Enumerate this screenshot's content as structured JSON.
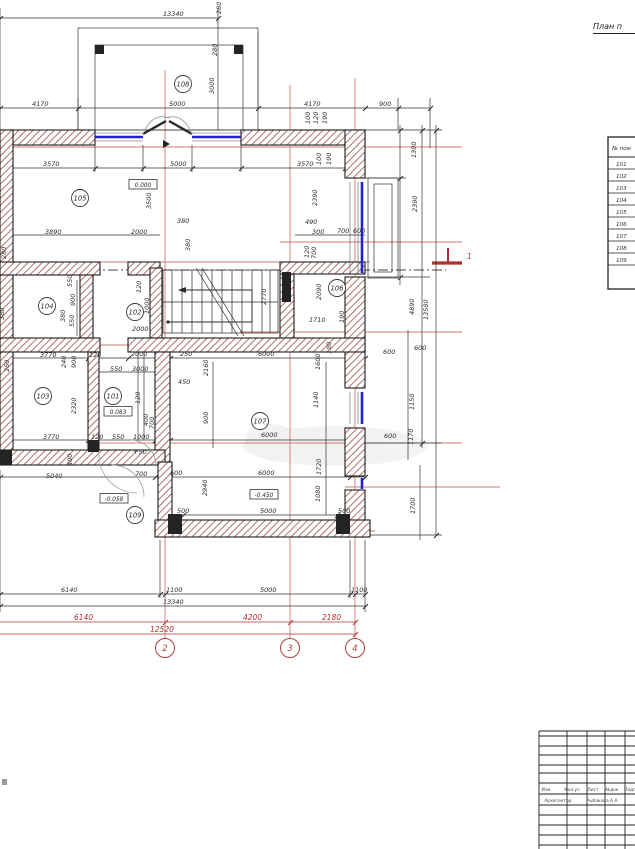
{
  "title": {
    "text": "План п"
  },
  "room_table": {
    "header": "№ пом",
    "rows": [
      "101",
      "102",
      "103",
      "104",
      "105",
      "106",
      "107",
      "108",
      "109"
    ]
  },
  "rooms": [
    {
      "n": "108",
      "x": 183,
      "y": 84
    },
    {
      "n": "105",
      "x": 80,
      "y": 198
    },
    {
      "n": "106",
      "x": 337,
      "y": 288
    },
    {
      "n": "104",
      "x": 47,
      "y": 306
    },
    {
      "n": "102",
      "x": 135,
      "y": 312
    },
    {
      "n": "103",
      "x": 43,
      "y": 396
    },
    {
      "n": "101",
      "x": 113,
      "y": 396
    },
    {
      "n": "107",
      "x": 260,
      "y": 421
    },
    {
      "n": "109",
      "x": 135,
      "y": 515
    }
  ],
  "levels": [
    {
      "t": "0.000",
      "x": 143,
      "y": 186
    },
    {
      "t": "0.083",
      "x": 118,
      "y": 413
    },
    {
      "t": "-0.058",
      "x": 114,
      "y": 500
    },
    {
      "t": "-0.450",
      "x": 264,
      "y": 496
    }
  ],
  "axis_bubbles": [
    {
      "n": "2",
      "x": 165,
      "y": 648
    },
    {
      "n": "3",
      "x": 290,
      "y": 648
    },
    {
      "n": "4",
      "x": 355,
      "y": 648
    }
  ],
  "section_marker": {
    "label": "1",
    "x": 467,
    "y": 259
  },
  "dims_black": [
    {
      "t": "13340",
      "x": 163,
      "y": 16
    },
    {
      "t": "280",
      "x": 221,
      "y": 14,
      "r": 1
    },
    {
      "t": "280",
      "x": 217,
      "y": 56,
      "r": 1
    },
    {
      "t": "3000",
      "x": 214,
      "y": 94,
      "r": 1
    },
    {
      "t": "4170",
      "x": 32,
      "y": 106
    },
    {
      "t": "5000",
      "x": 169,
      "y": 106
    },
    {
      "t": "4170",
      "x": 304,
      "y": 106
    },
    {
      "t": "900",
      "x": 379,
      "y": 106
    },
    {
      "t": "100",
      "x": 310,
      "y": 124,
      "r": 1
    },
    {
      "t": "120",
      "x": 318,
      "y": 124,
      "r": 1
    },
    {
      "t": "190",
      "x": 327,
      "y": 124,
      "r": 1
    },
    {
      "t": "3570",
      "x": 43,
      "y": 166
    },
    {
      "t": "5000",
      "x": 170,
      "y": 166
    },
    {
      "t": "3570",
      "x": 297,
      "y": 166
    },
    {
      "t": "100",
      "x": 321,
      "y": 165,
      "r": 1
    },
    {
      "t": "190",
      "x": 331,
      "y": 165,
      "r": 1
    },
    {
      "t": "1300",
      "x": 416,
      "y": 158,
      "r": 1
    },
    {
      "t": "3500",
      "x": 151,
      "y": 209,
      "r": 1
    },
    {
      "t": "2390",
      "x": 317,
      "y": 206,
      "r": 1
    },
    {
      "t": "2390",
      "x": 417,
      "y": 212,
      "r": 1
    },
    {
      "t": "3890",
      "x": 45,
      "y": 234
    },
    {
      "t": "2000",
      "x": 131,
      "y": 234
    },
    {
      "t": "380",
      "x": 177,
      "y": 223
    },
    {
      "t": "380",
      "x": 190,
      "y": 251,
      "r": 1
    },
    {
      "t": "490",
      "x": 305,
      "y": 224
    },
    {
      "t": "300",
      "x": 312,
      "y": 234
    },
    {
      "t": "700",
      "x": 337,
      "y": 233
    },
    {
      "t": "600",
      "x": 353,
      "y": 233
    },
    {
      "t": "280",
      "x": 6,
      "y": 259,
      "r": 1
    },
    {
      "t": "120",
      "x": 309,
      "y": 258,
      "r": 1
    },
    {
      "t": "700",
      "x": 316,
      "y": 259,
      "r": 1
    },
    {
      "t": "550",
      "x": 72,
      "y": 287,
      "r": 1
    },
    {
      "t": "900",
      "x": 75,
      "y": 306,
      "r": 1
    },
    {
      "t": "380",
      "x": 65,
      "y": 322,
      "r": 1
    },
    {
      "t": "550",
      "x": 74,
      "y": 327,
      "r": 1
    },
    {
      "t": "120",
      "x": 141,
      "y": 293,
      "r": 1
    },
    {
      "t": "1000",
      "x": 149,
      "y": 314,
      "r": 1
    },
    {
      "t": "2000",
      "x": 132,
      "y": 331
    },
    {
      "t": "2770",
      "x": 266,
      "y": 305,
      "r": 1
    },
    {
      "t": "2090",
      "x": 321,
      "y": 300,
      "r": 1
    },
    {
      "t": "1710",
      "x": 309,
      "y": 322
    },
    {
      "t": "190",
      "x": 344,
      "y": 323,
      "r": 1
    },
    {
      "t": "380",
      "x": 4,
      "y": 320,
      "r": 1
    },
    {
      "t": "3770",
      "x": 40,
      "y": 357
    },
    {
      "t": "120",
      "x": 89,
      "y": 357
    },
    {
      "t": "2000",
      "x": 131,
      "y": 356
    },
    {
      "t": "250",
      "x": 180,
      "y": 356
    },
    {
      "t": "6000",
      "x": 258,
      "y": 356
    },
    {
      "t": "190",
      "x": 331,
      "y": 354,
      "r": 1
    },
    {
      "t": "600",
      "x": 383,
      "y": 354
    },
    {
      "t": "600",
      "x": 414,
      "y": 350
    },
    {
      "t": "240",
      "x": 66,
      "y": 368,
      "r": 1
    },
    {
      "t": "900",
      "x": 76,
      "y": 368,
      "r": 1
    },
    {
      "t": "260",
      "x": 9,
      "y": 372,
      "r": 1
    },
    {
      "t": "550",
      "x": 110,
      "y": 371
    },
    {
      "t": "3000",
      "x": 132,
      "y": 371
    },
    {
      "t": "450",
      "x": 178,
      "y": 384
    },
    {
      "t": "2160",
      "x": 208,
      "y": 376,
      "r": 1
    },
    {
      "t": "1600",
      "x": 320,
      "y": 370,
      "r": 1
    },
    {
      "t": "120",
      "x": 140,
      "y": 404,
      "r": 1
    },
    {
      "t": "400",
      "x": 148,
      "y": 426,
      "r": 1
    },
    {
      "t": "700",
      "x": 154,
      "y": 429,
      "r": 1
    },
    {
      "t": "2320",
      "x": 76,
      "y": 414,
      "r": 1
    },
    {
      "t": "1140",
      "x": 318,
      "y": 408,
      "r": 1
    },
    {
      "t": "1150",
      "x": 414,
      "y": 410,
      "r": 1
    },
    {
      "t": "900",
      "x": 208,
      "y": 424,
      "r": 1
    },
    {
      "t": "6000",
      "x": 261,
      "y": 437
    },
    {
      "t": "3770",
      "x": 43,
      "y": 439
    },
    {
      "t": "120",
      "x": 91,
      "y": 439
    },
    {
      "t": "550",
      "x": 112,
      "y": 439
    },
    {
      "t": "1000",
      "x": 133,
      "y": 439
    },
    {
      "t": "+50",
      "x": 133,
      "y": 454
    },
    {
      "t": "700",
      "x": 135,
      "y": 476
    },
    {
      "t": "400",
      "x": 72,
      "y": 466,
      "r": 1
    },
    {
      "t": "5040",
      "x": 46,
      "y": 478
    },
    {
      "t": "600",
      "x": 170,
      "y": 475
    },
    {
      "t": "6000",
      "x": 258,
      "y": 475
    },
    {
      "t": "1720",
      "x": 321,
      "y": 475,
      "r": 1
    },
    {
      "t": "600",
      "x": 384,
      "y": 438
    },
    {
      "t": "1170",
      "x": 413,
      "y": 445,
      "r": 1
    },
    {
      "t": "2940",
      "x": 207,
      "y": 496,
      "r": 1
    },
    {
      "t": "1080",
      "x": 320,
      "y": 502,
      "r": 1
    },
    {
      "t": "500",
      "x": 177,
      "y": 513
    },
    {
      "t": "5000",
      "x": 260,
      "y": 513
    },
    {
      "t": "500",
      "x": 338,
      "y": 513
    },
    {
      "t": "1700",
      "x": 415,
      "y": 514,
      "r": 1
    },
    {
      "t": "4890",
      "x": 414,
      "y": 315,
      "r": 1
    },
    {
      "t": "13580",
      "x": 428,
      "y": 320,
      "r": 1
    },
    {
      "t": "6140",
      "x": 61,
      "y": 592
    },
    {
      "t": "1100",
      "x": 166,
      "y": 592
    },
    {
      "t": "5000",
      "x": 260,
      "y": 592
    },
    {
      "t": "1100",
      "x": 351,
      "y": 592
    },
    {
      "t": "13340",
      "x": 163,
      "y": 604
    }
  ],
  "dims_red": [
    {
      "t": "6140",
      "x": 74,
      "y": 620
    },
    {
      "t": "4200",
      "x": 243,
      "y": 620
    },
    {
      "t": "2180",
      "x": 322,
      "y": 620
    },
    {
      "t": "12520",
      "x": 150,
      "y": 632
    }
  ],
  "titleblock": {
    "cells": [
      {
        "t": "Изм",
        "x": 546,
        "y": 791
      },
      {
        "t": "Кол.уч",
        "x": 572,
        "y": 791
      },
      {
        "t": "Лист",
        "x": 593,
        "y": 791
      },
      {
        "t": "№док",
        "x": 612,
        "y": 791
      },
      {
        "t": "Подп",
        "x": 630,
        "y": 791
      },
      {
        "t": "Архитектор",
        "x": 558,
        "y": 802
      },
      {
        "t": "Рыбакова А.А",
        "x": 602,
        "y": 802
      }
    ]
  },
  "colors": {
    "axis_red": "#cc7a7a",
    "dim_red": "#b33030",
    "window_blue": "#2323c8",
    "wall_hatch": "#a35757",
    "line_black": "#222222"
  }
}
